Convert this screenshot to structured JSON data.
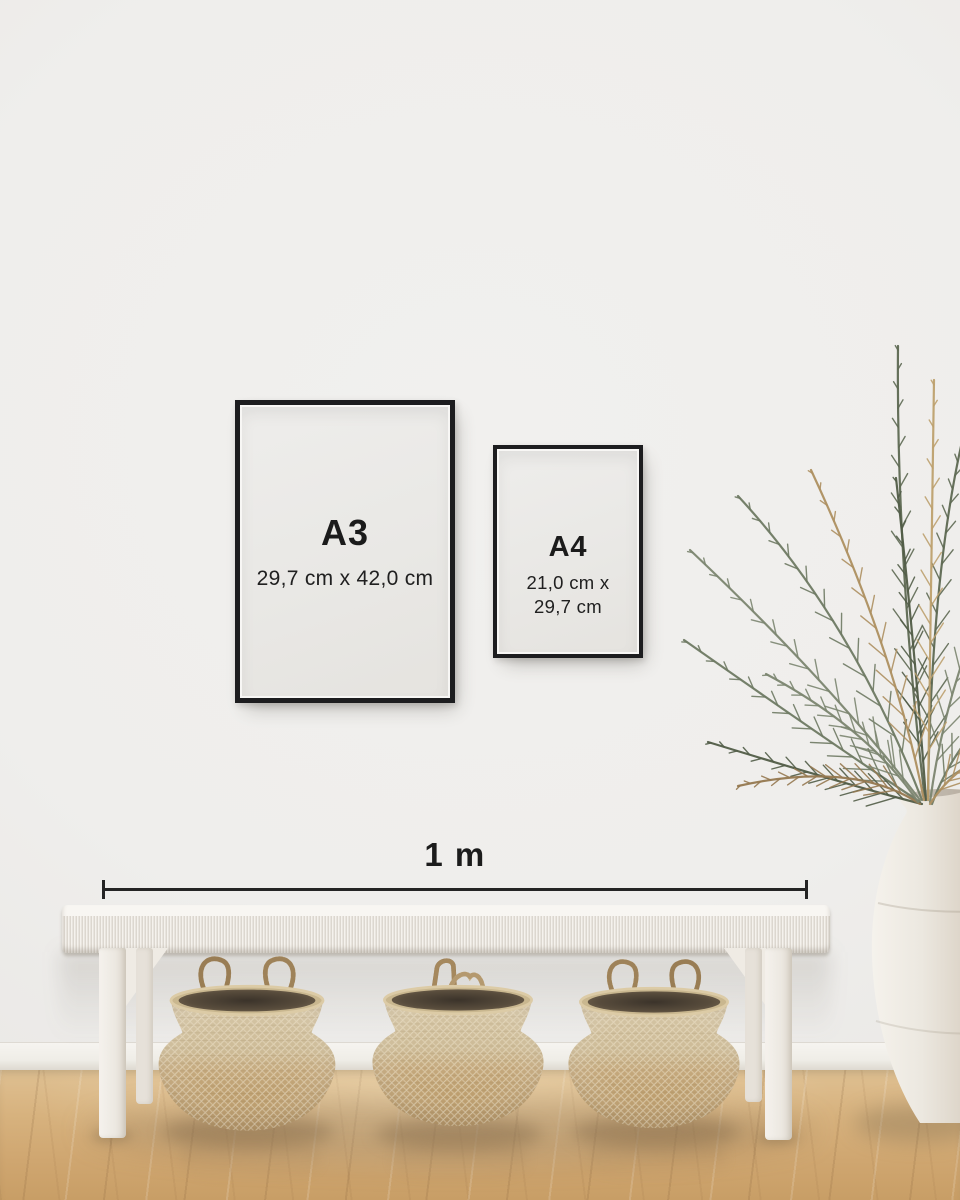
{
  "size_guide": {
    "frames": [
      {
        "label": "A3",
        "dimensions": "29,7 cm x 42,0 cm"
      },
      {
        "label": "A4",
        "dimensions": "21,0 cm x 29,7 cm"
      }
    ],
    "measurement": {
      "label": "1 m"
    }
  },
  "palette": {
    "frame_border": "#1d1d1f",
    "text_dark": "#1b1b1b",
    "measure_line": "#242424",
    "wall": "#efeeec",
    "baseboard": "#f6f4f0",
    "floor_light": "#dfc092",
    "floor_dark": "#c89e66",
    "bench_white": "#f5f2ed",
    "basket_tan": "#c2a276",
    "basket_light": "#d3c4a5",
    "basket_interior": "#473d31",
    "rope": "#ab8e61",
    "vase_cream": "#f0ede7",
    "plant_green": "#6e7963",
    "plant_tan": "#ad8f60"
  }
}
